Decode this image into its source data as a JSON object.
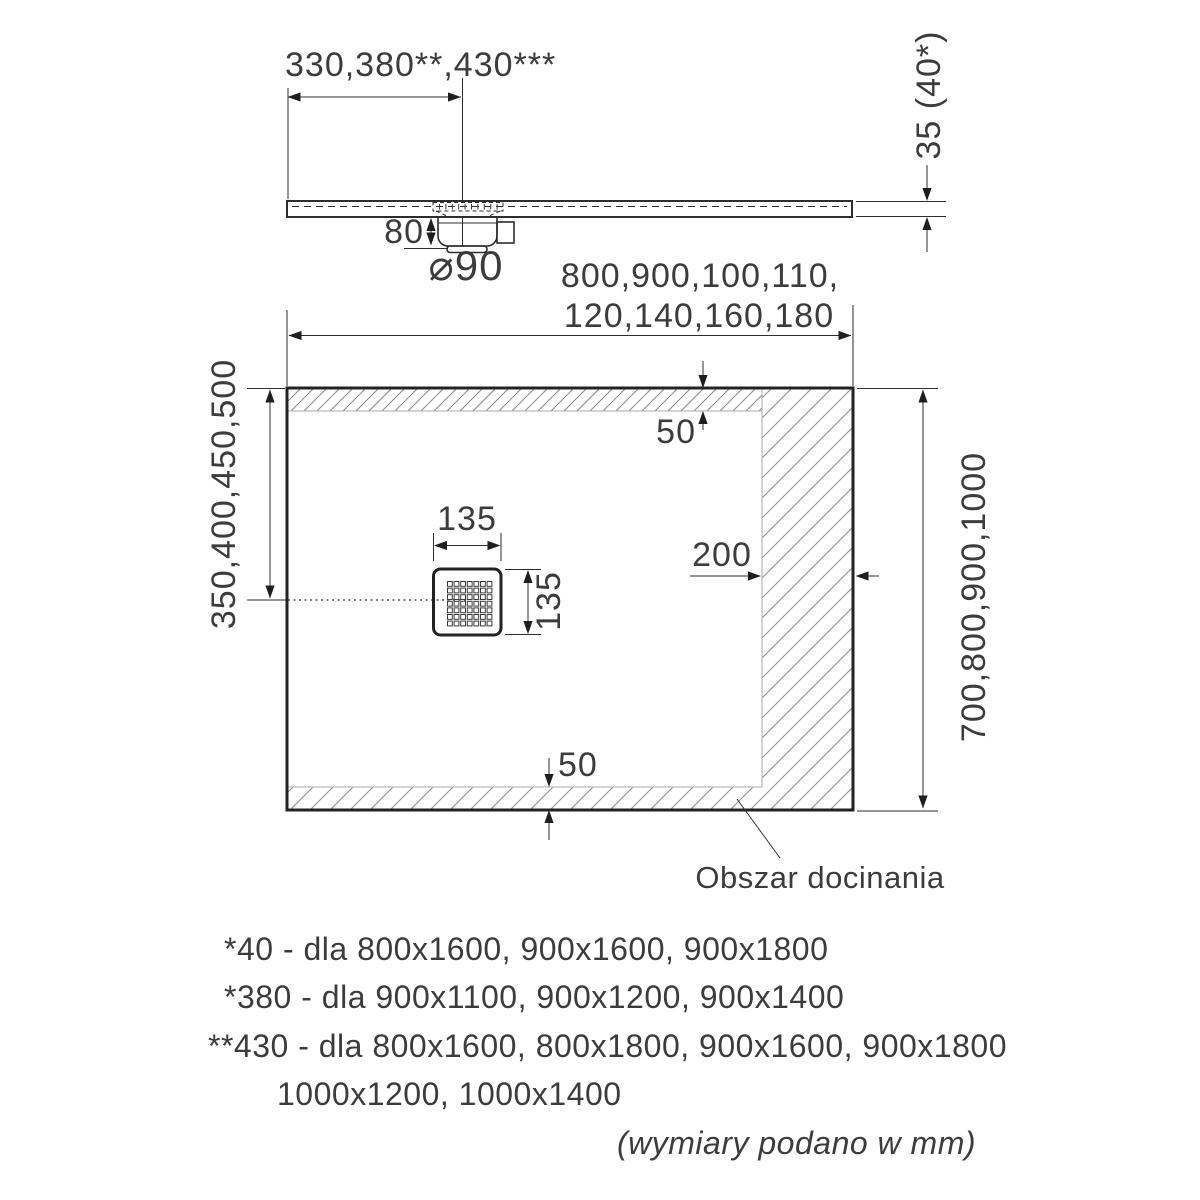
{
  "drawing": {
    "side_view": {
      "drain_offset": "330,380**,430***",
      "thickness": "35 (40*)",
      "trap_depth": "80",
      "drain_diameter": "⌀90"
    },
    "plan_view": {
      "width_options_line1": "800,900,100,110,",
      "width_options_line2": "120,140,160,180",
      "drain_center_offset": "350,400,450,500",
      "length_options": "700,800,900,1000",
      "top_margin": "50",
      "bottom_margin": "50",
      "side_margin": "200",
      "grate_width": "135",
      "grate_height": "135",
      "trim_area_label": "Obszar docinania"
    },
    "notes": [
      "*40 - dla 800x1600, 900x1600, 900x1800",
      "*380 - dla 900x1100, 900x1200, 900x1400",
      "**430 - dla 800x1600, 800x1800, 900x1600, 900x1800",
      "1000x1200, 1000x1400"
    ],
    "footer": "(wymiary podano w mm)"
  }
}
